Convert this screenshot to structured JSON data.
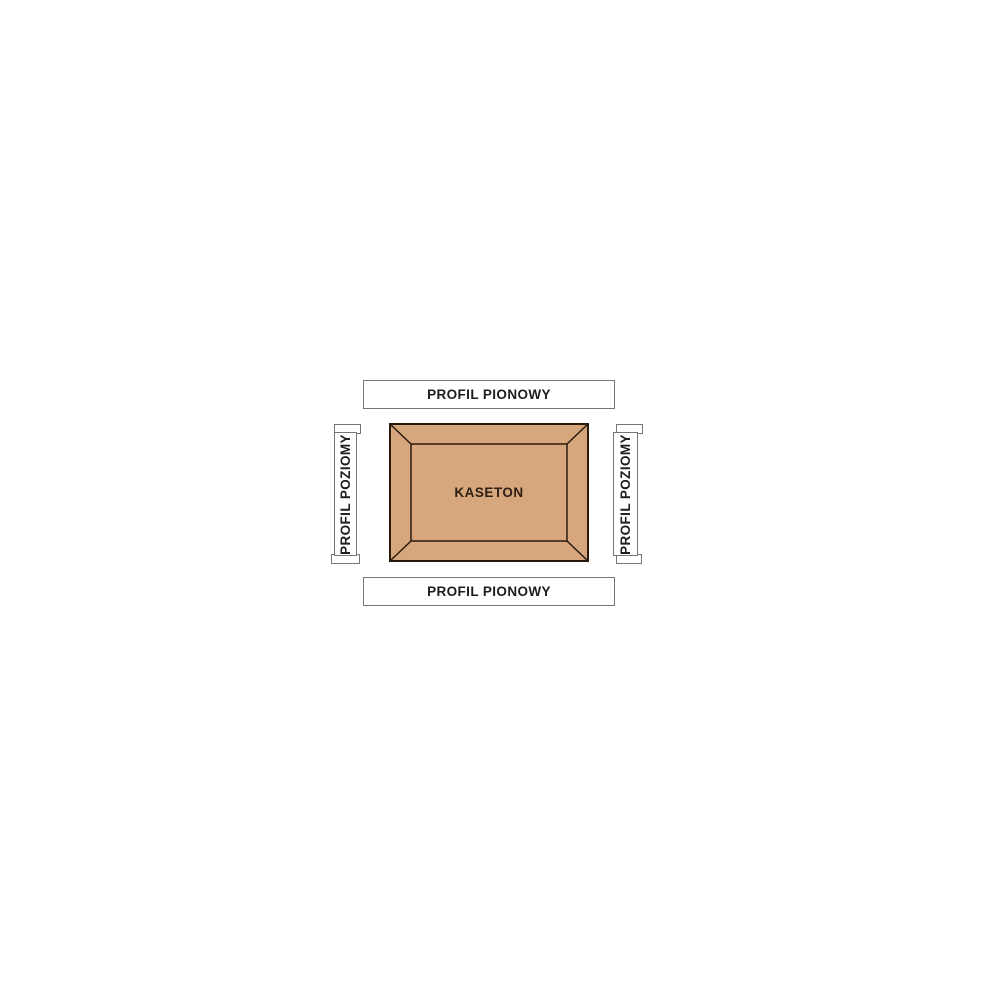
{
  "diagram": {
    "kaseton": {
      "label": "KASETON"
    },
    "profiles": {
      "top": {
        "label": "PROFIL PIONOWY"
      },
      "bottom": {
        "label": "PROFIL PIONOWY"
      },
      "left": {
        "label": "PROFIL POZIOMY"
      },
      "right": {
        "label": "PROFIL POZIOMY"
      }
    },
    "colors": {
      "background": "#ffffff",
      "panel_fill": "#d6a67c",
      "panel_outline": "#2a1a0c",
      "panel_text": "#2e2014",
      "label_text": "#1d1d1d",
      "label_border": "#757575",
      "label_fill": "#ffffff"
    }
  }
}
